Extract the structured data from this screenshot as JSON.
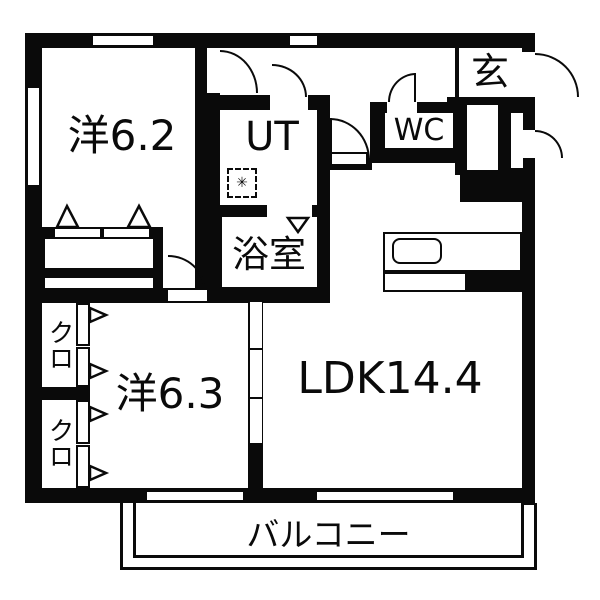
{
  "floorplan": {
    "labels": {
      "western1": "洋6.2",
      "ut": "UT",
      "wc": "WC",
      "genkan": "玄",
      "bath": "浴室",
      "western2": "洋6.3",
      "closet1": "クロ",
      "closet2": "クロ",
      "ldk": "LDK14.4",
      "balcony": "バルコニー"
    },
    "symbols": {
      "washing_machine": "✳"
    },
    "colors": {
      "wall": "#0a0a0a",
      "floor": "#ffffff"
    }
  }
}
